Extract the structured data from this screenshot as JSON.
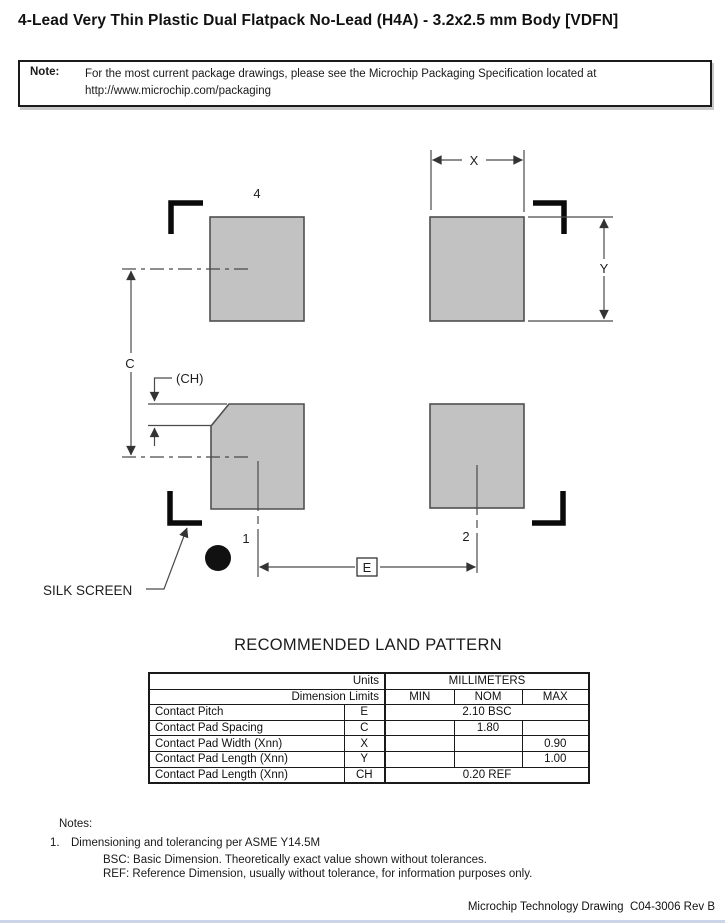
{
  "page": {
    "title": "4-Lead Very Thin Plastic Dual Flatpack No-Lead (H4A) - 3.2x2.5 mm Body [VDFN]",
    "footer": "Microchip Technology Drawing  C04-3006 Rev B"
  },
  "note": {
    "label": "Note:",
    "lines": [
      "For the most current package drawings, please see the Microchip Packaging Specification located at",
      "http://www.microchip.com/packaging"
    ]
  },
  "drawing": {
    "pin4_label": "4",
    "pin1_label": "1",
    "pin2_label": "2",
    "dim_x": "X",
    "dim_y": "Y",
    "dim_c": "C",
    "dim_ch": "(CH)",
    "dim_e": "E",
    "silk_screen_label": "SILK SCREEN",
    "pad_fill": "#c2c2c2",
    "pad_stroke": "#4f4f4f",
    "line_color": "#4a4a4a",
    "bracket_color": "#0a0a0a"
  },
  "land_pattern": {
    "heading": "RECOMMENDED LAND PATTERN",
    "table": {
      "units_label": "Units",
      "units_value": "MILLIMETERS",
      "dimension_limits_label": "Dimension Limits",
      "columns": [
        "MIN",
        "NOM",
        "MAX"
      ],
      "rows": [
        {
          "name": "Contact Pitch",
          "symbol": "E",
          "span": "2.10 BSC"
        },
        {
          "name": "Contact Pad Spacing",
          "symbol": "C",
          "min": "",
          "nom": "1.80",
          "max": ""
        },
        {
          "name": "Contact Pad Width (Xnn)",
          "symbol": "X",
          "min": "",
          "nom": "",
          "max": "0.90"
        },
        {
          "name": "Contact Pad Length (Xnn)",
          "symbol": "Y",
          "min": "",
          "nom": "",
          "max": "1.00"
        },
        {
          "name": "Contact Pad Length (Xnn)",
          "symbol": "CH",
          "span": "0.20 REF"
        }
      ]
    }
  },
  "notes": {
    "heading": "Notes:",
    "item_number": "1.",
    "item_text": "Dimensioning and tolerancing per ASME Y14.5M",
    "sub_items": [
      "BSC: Basic Dimension. Theoretically exact value shown without tolerances.",
      "REF: Reference Dimension, usually without tolerance, for information purposes only."
    ]
  }
}
